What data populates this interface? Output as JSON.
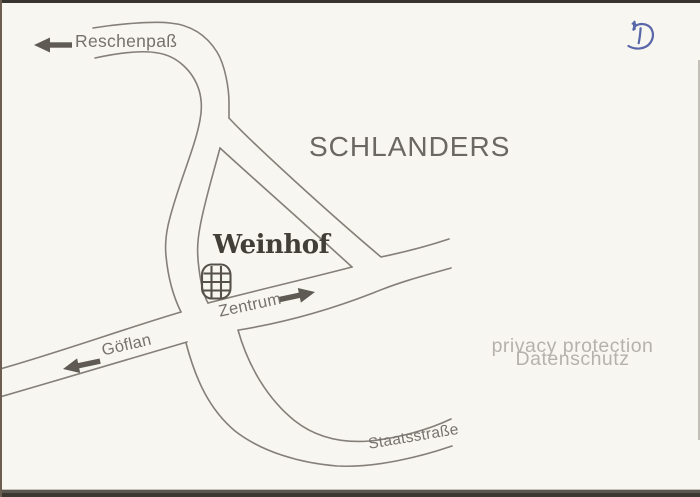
{
  "postcard": {
    "town": "SCHLANDERS",
    "poi": "Weinhof",
    "road_labels": {
      "north": "Reschenpaß",
      "west": "Göflan",
      "center": "Zentrum",
      "south": "Staatsstraße"
    }
  },
  "watermark": {
    "line1": "privacy protection",
    "line2": "Datenschutz"
  },
  "logo": {
    "letter": "D",
    "color": "#5966a9"
  },
  "colors": {
    "paper": "#f8f6f0",
    "road_line": "#847f78",
    "road_label_text": "#76716c",
    "town_text": "#6b6762",
    "poi_text": "#423e38",
    "arrow": "#5f5a54",
    "watermark_text": "#b5b1ad"
  }
}
